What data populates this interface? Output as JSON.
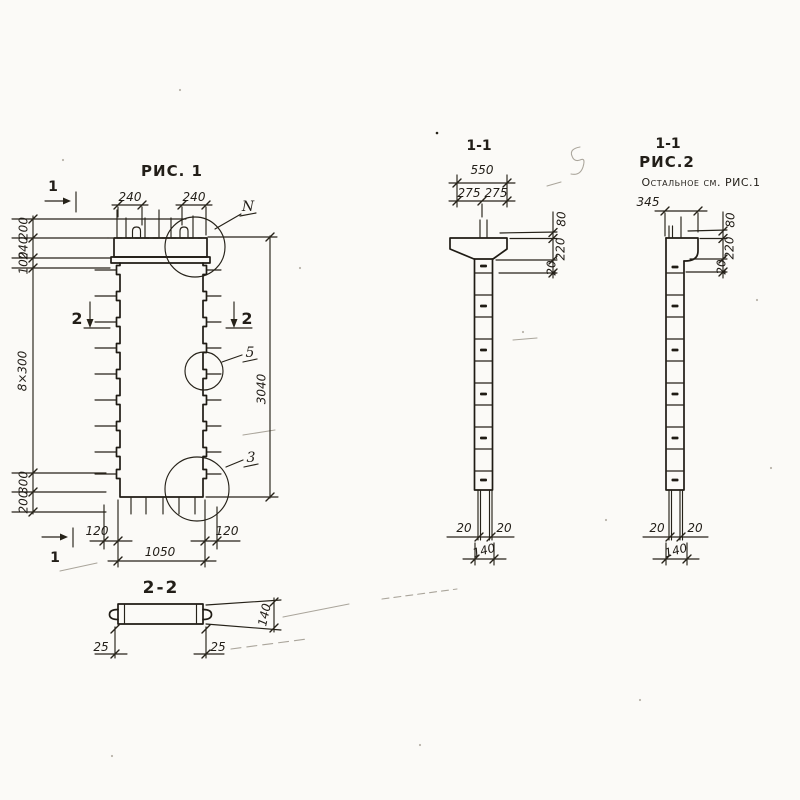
{
  "colors": {
    "paper": "#fbfaf7",
    "ink": "#262219",
    "faint": "#aaa59b"
  },
  "fig1": {
    "title": "РИС. 1",
    "section_marker_top": "1",
    "section_marker_bottom": "1",
    "section_marker_left": "2",
    "section_marker_right": "2",
    "callout_top": "N",
    "callout_middle": "5",
    "callout_bottom": "3",
    "dim_top_left": "240",
    "dim_top_right": "240",
    "dim_left_1": "200",
    "dim_left_2": "240",
    "dim_left_3": "100",
    "dim_left_4": "8×300",
    "dim_left_5": "300",
    "dim_left_6": "200",
    "dim_height": "3040",
    "dim_bottom_left": "120",
    "dim_bottom_right": "120",
    "dim_bottom_width": "1050"
  },
  "section_1_1": {
    "title": "1-1",
    "dim_width": "550",
    "dim_left_half": "275",
    "dim_right_half": "275",
    "dim_pin_height": "80",
    "dim_cap_height": "220",
    "dim_step": "20",
    "dim_rod_left": "20",
    "dim_rod_right": "20",
    "dim_base_width": "140"
  },
  "fig2": {
    "section_title": "1-1",
    "title": "РИС.2",
    "note": "Остальное см. РИС.1",
    "dim_width": "345",
    "dim_pin_height": "80",
    "dim_cap_height": "220",
    "dim_step": "20",
    "dim_rod_left": "20",
    "dim_rod_right": "20",
    "dim_base_width": "140"
  },
  "section_2_2": {
    "title": "2-2",
    "dim_left": "25",
    "dim_right": "25",
    "dim_height": "140"
  }
}
